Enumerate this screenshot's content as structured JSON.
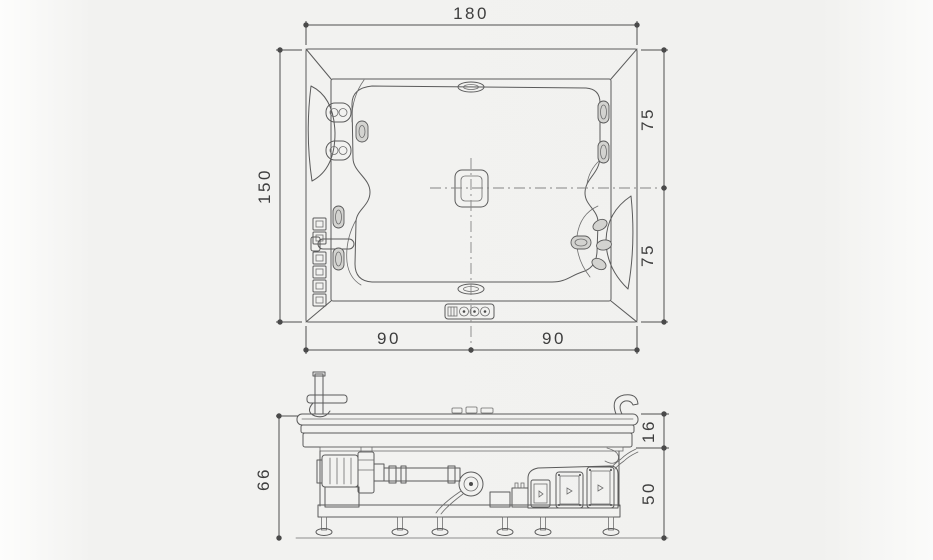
{
  "colors": {
    "paper": "#f1f1ef",
    "page_edge": "#fdfdfc",
    "drawing_line": "#5b5b5b",
    "dimension_line": "#4e4e4e",
    "dimension_text": "#3e3e3e",
    "centerline": "#858585",
    "jet_fill": "#d3d3d0"
  },
  "top_view": {
    "dims": {
      "total_width": "180",
      "total_depth": "150",
      "depth_upper": "75",
      "depth_lower": "75",
      "width_left": "90",
      "width_right": "90"
    }
  },
  "side_view": {
    "dims": {
      "total_height": "66",
      "rim_height": "16",
      "frame_height": "50"
    }
  }
}
